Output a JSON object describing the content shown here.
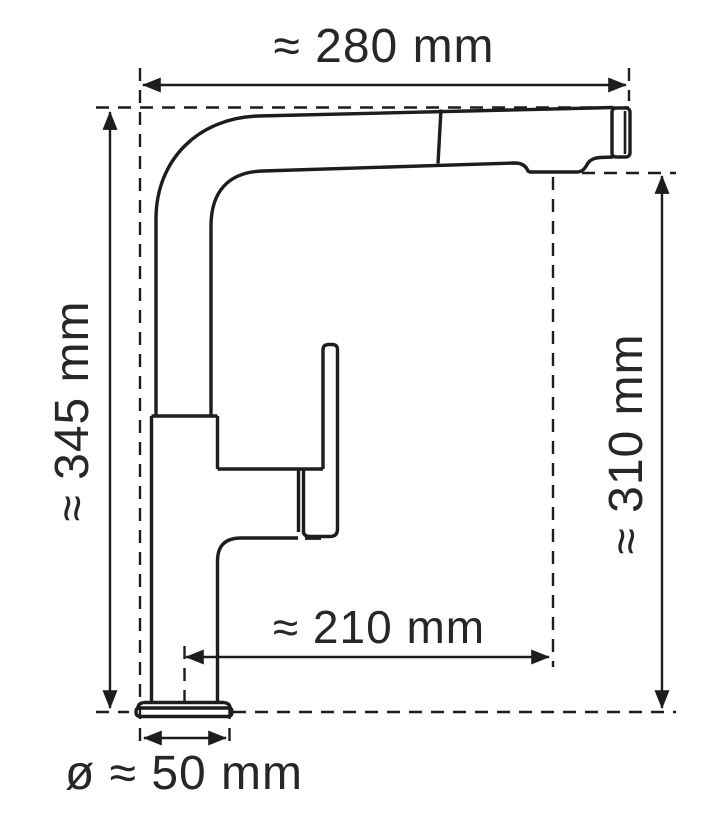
{
  "drawing": {
    "subject": "Pull-out kitchen faucet, side view technical dimension drawing",
    "background_color": "#ffffff",
    "line_color": "#1d1d1b",
    "text_color": "#272725",
    "unit": "mm",
    "dimensions": {
      "total_width": {
        "label": "≈ 280 mm",
        "value": 280,
        "approx": true,
        "orientation": "horizontal-top"
      },
      "total_height": {
        "label": "≈ 345 mm",
        "value": 345,
        "approx": true,
        "orientation": "vertical-left"
      },
      "outlet_height": {
        "label": "≈ 310 mm",
        "value": 310,
        "approx": true,
        "orientation": "vertical-right"
      },
      "spout_reach": {
        "label": "≈ 210 mm",
        "value": 210,
        "approx": true,
        "orientation": "horizontal-middle"
      },
      "base_diameter": {
        "label": "ø ≈ 50 mm",
        "value": 50,
        "approx": true,
        "orientation": "horizontal-bottom"
      }
    }
  }
}
